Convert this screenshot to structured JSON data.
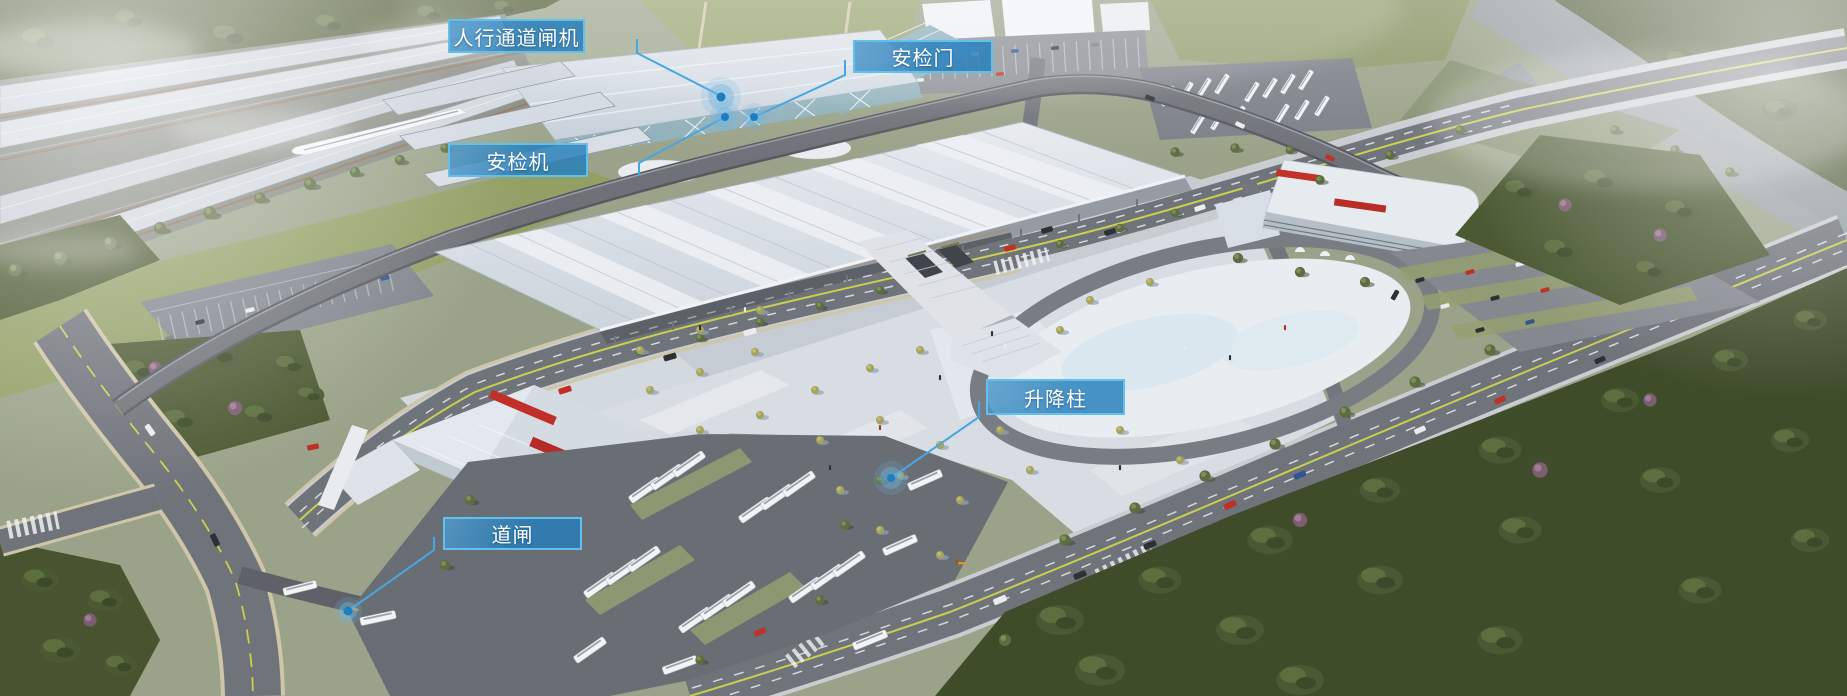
{
  "colors": {
    "label_bg": "#247EBC",
    "label_border": "#62C0EC",
    "label_text": "#FFFFFF",
    "leader_line": "#46A6E2",
    "marker_dot": "#1B7EC2",
    "marker_halo": "#6FB4E0"
  },
  "callouts": [
    {
      "id": "pedestrian-channel-gate",
      "label": "人行通道闸机",
      "target": "station-roof-entrance",
      "box": {
        "x": 448,
        "y": 19,
        "w": 137,
        "h": 34
      },
      "line": [
        [
          637,
          39
        ],
        [
          637,
          53
        ],
        [
          721,
          96
        ]
      ],
      "dot": {
        "x": 721,
        "y": 97,
        "r": 4.5,
        "halo": 13
      }
    },
    {
      "id": "security-door",
      "label": "安检门",
      "target": "station-north-entrance",
      "box": {
        "x": 853,
        "y": 40,
        "w": 140,
        "h": 33
      },
      "line": [
        [
          845,
          60
        ],
        [
          845,
          75
        ],
        [
          754,
          117
        ]
      ],
      "dot": {
        "x": 754,
        "y": 117,
        "r": 4,
        "halo": 9
      }
    },
    {
      "id": "security-scanner",
      "label": "安检机",
      "target": "station-front-facade",
      "box": {
        "x": 448,
        "y": 143,
        "w": 140,
        "h": 34
      },
      "line": [
        [
          639,
          176
        ],
        [
          639,
          163
        ],
        [
          725,
          117
        ]
      ],
      "dot": {
        "x": 725,
        "y": 117,
        "r": 4,
        "halo": 10
      }
    },
    {
      "id": "lifting-bollard",
      "label": "升降柱",
      "target": "plaza-ring-road-entrance",
      "box": {
        "x": 986,
        "y": 379,
        "w": 139,
        "h": 36
      },
      "line": [
        [
          979,
          401
        ],
        [
          979,
          417
        ],
        [
          891,
          478
        ]
      ],
      "dot": {
        "x": 891,
        "y": 478,
        "r": 4,
        "halo": 11
      }
    },
    {
      "id": "road-barrier",
      "label": "道闸",
      "target": "bus-parking-entrance",
      "box": {
        "x": 443,
        "y": 517,
        "w": 139,
        "h": 33
      },
      "line": [
        [
          434,
          537
        ],
        [
          434,
          550
        ],
        [
          348,
          611
        ]
      ],
      "dot": {
        "x": 348,
        "y": 611,
        "r": 4.5,
        "halo": 9
      }
    }
  ]
}
